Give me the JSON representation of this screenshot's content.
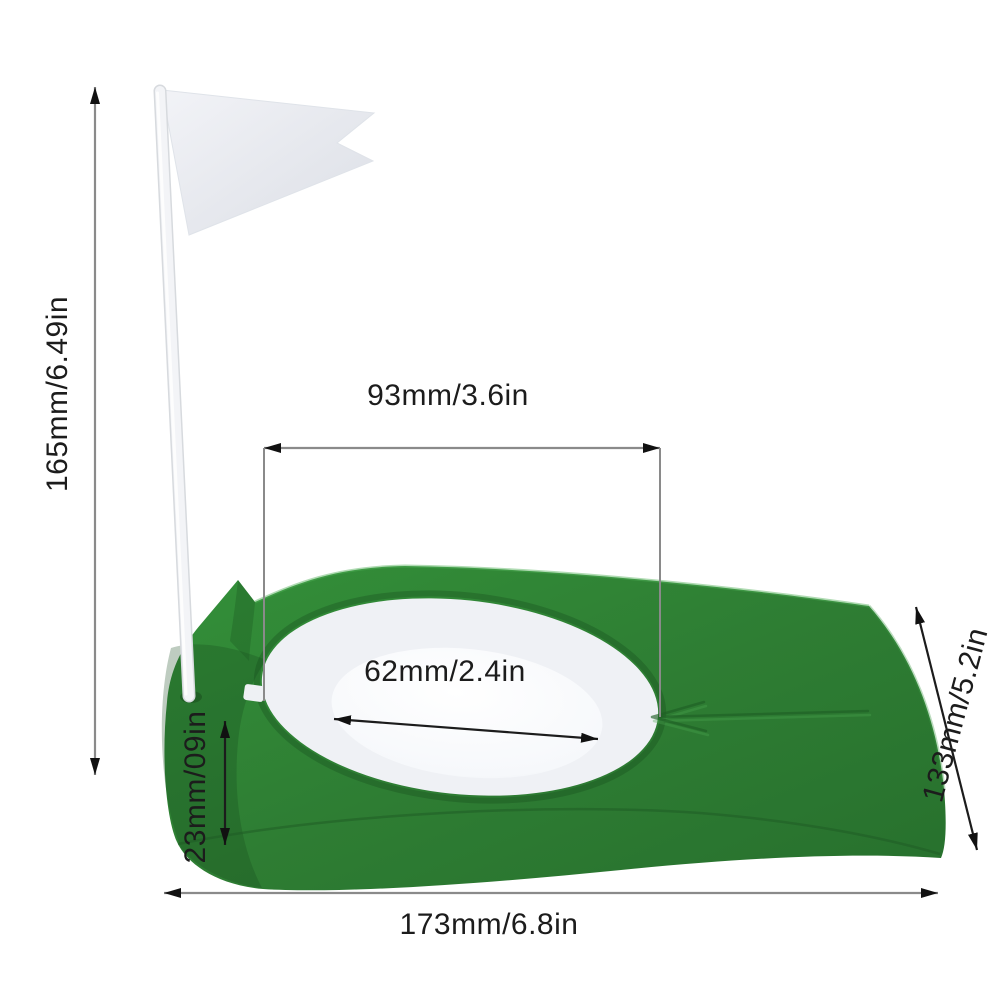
{
  "figure": {
    "kind": "product-dimension-diagram",
    "subject": "golf putting cup with flag",
    "background": "#ffffff"
  },
  "colors": {
    "green": "#2e7d33",
    "green_dark": "#1d5a22",
    "green_light": "#4faf57",
    "ring_white": "#eff1f5",
    "hole_white": "#fbfcfe",
    "flag_white": "#e9ebf0",
    "pole_white": "#f3f4f7",
    "dimension_line_gray": "#8a8a8a",
    "dimension_text": "#1c1c1c"
  },
  "dimensions": {
    "flag_height": "165mm/6.49in",
    "cup_outer_width": "93mm/3.6in",
    "hole_diameter": "62mm/2.4in",
    "base_thickness": "23mm/09in",
    "base_depth": "133mm/5.2in",
    "base_length": "173mm/6.8in"
  }
}
